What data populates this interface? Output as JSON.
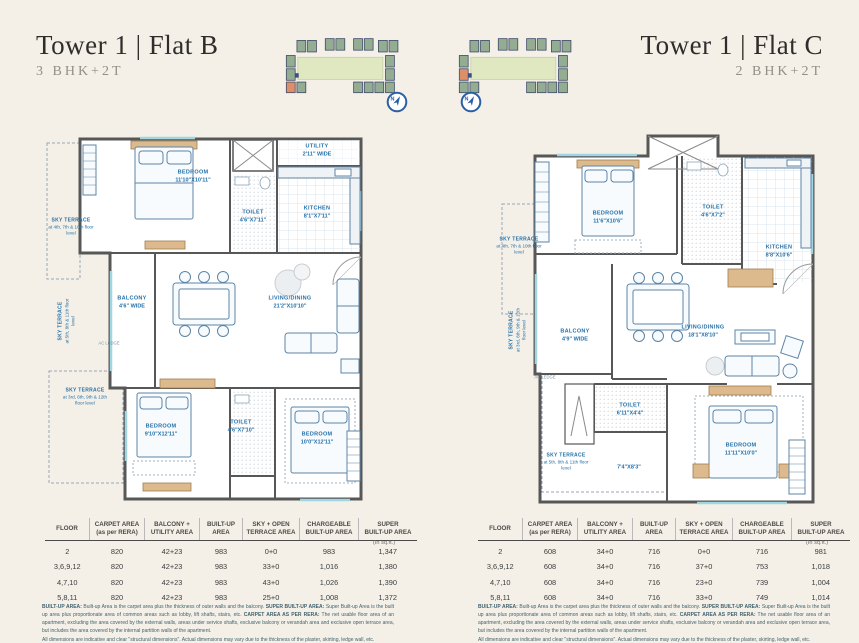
{
  "colors": {
    "page_bg": "#f4f0e7",
    "label_blue": "#2470a8",
    "wall_gray": "#575757",
    "map_lawn_green": "#e0e8c2",
    "map_building_green": "#94ad92",
    "map_highlight_orange": "#df8f68",
    "compass_blue": "#2a5fa5",
    "wood_tan": "#dcba8e"
  },
  "meta": {
    "unit_note": "(In sq.ft.)"
  },
  "site_maps": {
    "north_label": "N"
  },
  "flat_b": {
    "title": "Tower 1 | Flat B",
    "subtitle": "3 BHK+2T",
    "rooms": {
      "bedroom1": {
        "name": "BEDROOM",
        "dims": "11'10\"X10'11\""
      },
      "toilet1": {
        "name": "TOILET",
        "dims": "4'6\"X7'11\""
      },
      "kitchen": {
        "name": "KITCHEN",
        "dims": "8'1\"X7'11\""
      },
      "utility": {
        "name": "UTILITY",
        "dims": "2'11\" WIDE"
      },
      "balcony": {
        "name": "BALCONY",
        "dims": "4'6\" WIDE"
      },
      "living": {
        "name": "LIVING/DINING",
        "dims": "21'2\"X10'10\""
      },
      "bedroom2": {
        "name": "BEDROOM",
        "dims": "9'10\"X12'11\""
      },
      "toilet2": {
        "name": "TOILET",
        "dims": "4'6\"X7'10\""
      },
      "bedroom3": {
        "name": "BEDROOM",
        "dims": "10'0\"X12'11\""
      },
      "sky_terrace_top": {
        "name": "SKY TERRACE",
        "floors": "at 4th, 7th & 10th floor level"
      },
      "sky_terrace_side": {
        "name": "SKY TERRACE",
        "floors": "at 5th, 8th & 11th floor level"
      },
      "sky_terrace_bottom": {
        "name": "SKY TERRACE",
        "floors": "at 3rd, 6th, 9th & 12th floor level"
      },
      "ac_ledge": {
        "label": "AC LEDGE"
      }
    },
    "table": {
      "headers": [
        "FLOOR",
        "CARPET AREA\n(as per RERA)",
        "BALCONY +\nUTILITY AREA",
        "BUILT-UP\nAREA",
        "SKY + OPEN\nTERRACE AREA",
        "CHARGEABLE\nBUILT-UP AREA",
        "SUPER\nBUILT-UP AREA"
      ],
      "rows": [
        [
          "2",
          "820",
          "42+23",
          "983",
          "0+0",
          "983",
          "1,347"
        ],
        [
          "3,6,9,12",
          "820",
          "42+23",
          "983",
          "33+0",
          "1,016",
          "1,380"
        ],
        [
          "4,7,10",
          "820",
          "42+23",
          "983",
          "43+0",
          "1,026",
          "1,390"
        ],
        [
          "5,8,11",
          "820",
          "42+23",
          "983",
          "25+0",
          "1,008",
          "1,372"
        ]
      ]
    }
  },
  "flat_c": {
    "title": "Tower 1 | Flat C",
    "subtitle": "2 BHK+2T",
    "rooms": {
      "bedroom1": {
        "name": "BEDROOM",
        "dims": "11'6\"X10'6\""
      },
      "toilet1": {
        "name": "TOILET",
        "dims": "4'6\"X7'2\""
      },
      "kitchen": {
        "name": "KITCHEN",
        "dims": "8'8\"X10'6\""
      },
      "balcony": {
        "name": "BALCONY",
        "dims": "4'9\" WIDE"
      },
      "living": {
        "name": "LIVING/DINING",
        "dims": "18'1\"X8'10\""
      },
      "toilet2": {
        "name": "TOILET",
        "dims": "6'11\"X4'4\""
      },
      "bedroom2": {
        "name": "BEDROOM",
        "dims": "11'11\"X10'0\""
      },
      "open_terrace": {
        "dims": "7'4\"X8'3\""
      },
      "sky_terrace_top": {
        "name": "SKY TERRACE",
        "floors": "at 4th, 7th & 10th floor level"
      },
      "sky_terrace_side": {
        "name": "SKY TERRACE",
        "floors": "at 3rd, 6th, 9th & 12th floor level"
      },
      "sky_terrace_bottom": {
        "name": "SKY TERRACE",
        "floors": "at 5th, 8th & 11th floor level"
      },
      "ac_ledge": {
        "label": "AC LEDGE"
      }
    },
    "table": {
      "headers": [
        "FLOOR",
        "CARPET AREA\n(as per RERA)",
        "BALCONY +\nUTILITY AREA",
        "BUILT-UP\nAREA",
        "SKY + OPEN\nTERRACE AREA",
        "CHARGEABLE\nBUILT-UP AREA",
        "SUPER\nBUILT-UP AREA"
      ],
      "rows": [
        [
          "2",
          "608",
          "34+0",
          "716",
          "0+0",
          "716",
          "981"
        ],
        [
          "3,6,9,12",
          "608",
          "34+0",
          "716",
          "37+0",
          "753",
          "1,018"
        ],
        [
          "4,7,10",
          "608",
          "34+0",
          "716",
          "23+0",
          "739",
          "1,004"
        ],
        [
          "5,8,11",
          "608",
          "34+0",
          "716",
          "33+0",
          "749",
          "1,014"
        ]
      ]
    }
  },
  "disclaimer": {
    "d1_label": "BUILT-UP AREA:",
    "d1_text": " Built-up Area is the carpet area plus the thickness of outer walls and the balcony. ",
    "d2_label": "SUPER BUILT-UP AREA:",
    "d2_text": " Super Built-up Area is the built up area plus proportionate area of common areas such as lobby, lift shafts, stairs, etc. ",
    "d3_label": "CARPET AREA AS PER RERA:",
    "d3_text": " The net usable floor area of an apartment, excluding the area covered by the external walls, areas under service shafts, exclusive balcony or verandah area and exclusive open terrace area, but includes the area covered by the internal partition walls of the apartment.",
    "d4_text": "All dimensions are indicative and clear \"structural dimensions\". Actual dimensions may vary due to the thickness of the plaster, skirting, ledge wall, etc."
  }
}
